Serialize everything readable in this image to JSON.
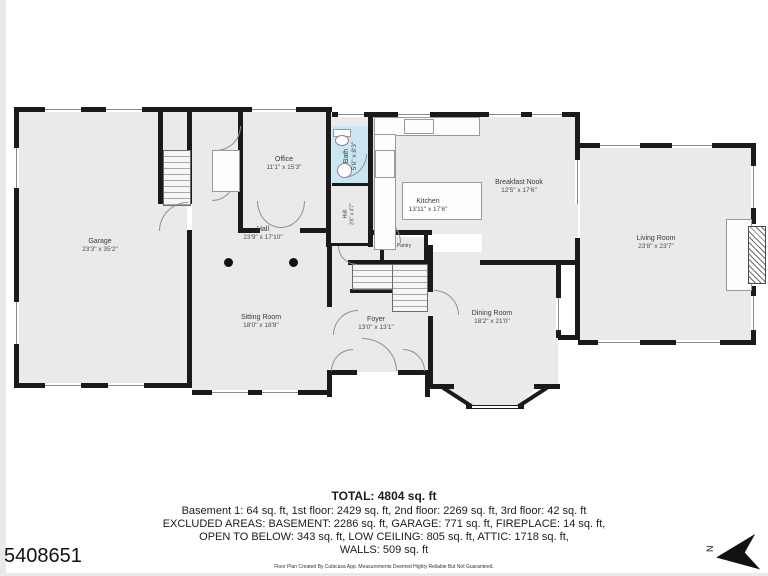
{
  "listing_id": "5408651",
  "floor_plan": {
    "colors": {
      "wall": "#1a1a1a",
      "floor": "#eaeaea",
      "bath": "#cbe5f3"
    },
    "compass_label": "N",
    "rooms": {
      "garage": {
        "name": "Garage",
        "dims": "23'3\" x 35'2\""
      },
      "office": {
        "name": "Office",
        "dims": "11'1\" x 15'3\""
      },
      "bath": {
        "name": "Bath",
        "dims": "5'6\" x 8'3\""
      },
      "hall_small": {
        "name": "Hall",
        "dims": "3'6\" x 4'7\""
      },
      "kitchen": {
        "name": "Kitchen",
        "dims": "13'11\" x 17'6\""
      },
      "breakfast_nook": {
        "name": "Breakfast Nook",
        "dims": "12'5\" x 17'6\""
      },
      "living_room": {
        "name": "Living Room",
        "dims": "23'8\" x 23'7\""
      },
      "hall": {
        "name": "Hall",
        "dims": "23'9\" x 17'10\""
      },
      "sitting_room": {
        "name": "Sitting Room",
        "dims": "18'0\" x 18'8\""
      },
      "foyer": {
        "name": "Foyer",
        "dims": "13'0\" x 13'1\""
      },
      "dining_room": {
        "name": "Dining Room",
        "dims": "18'2\" x 21'0\""
      },
      "pantry": {
        "name": "Pantry",
        "dims": ""
      }
    }
  },
  "summary": {
    "total": "TOTAL: 4804 sq. ft",
    "line1": "Basement 1: 64 sq. ft, 1st floor: 2429 sq. ft, 2nd floor: 2269 sq. ft, 3rd floor: 42 sq. ft",
    "line2": "EXCLUDED AREAS: BASEMENT: 2286 sq. ft, GARAGE: 771 sq. ft, FIREPLACE: 14 sq. ft,",
    "line3": "OPEN TO BELOW: 343 sq. ft, LOW CEILING: 805 sq. ft, ATTIC: 1718 sq. ft,",
    "line4": "WALLS: 509 sq. ft",
    "disclaimer": "Floor Plan Created By Cubicasa App. Measurements Deemed Highly Reliable But Not Guaranteed."
  }
}
